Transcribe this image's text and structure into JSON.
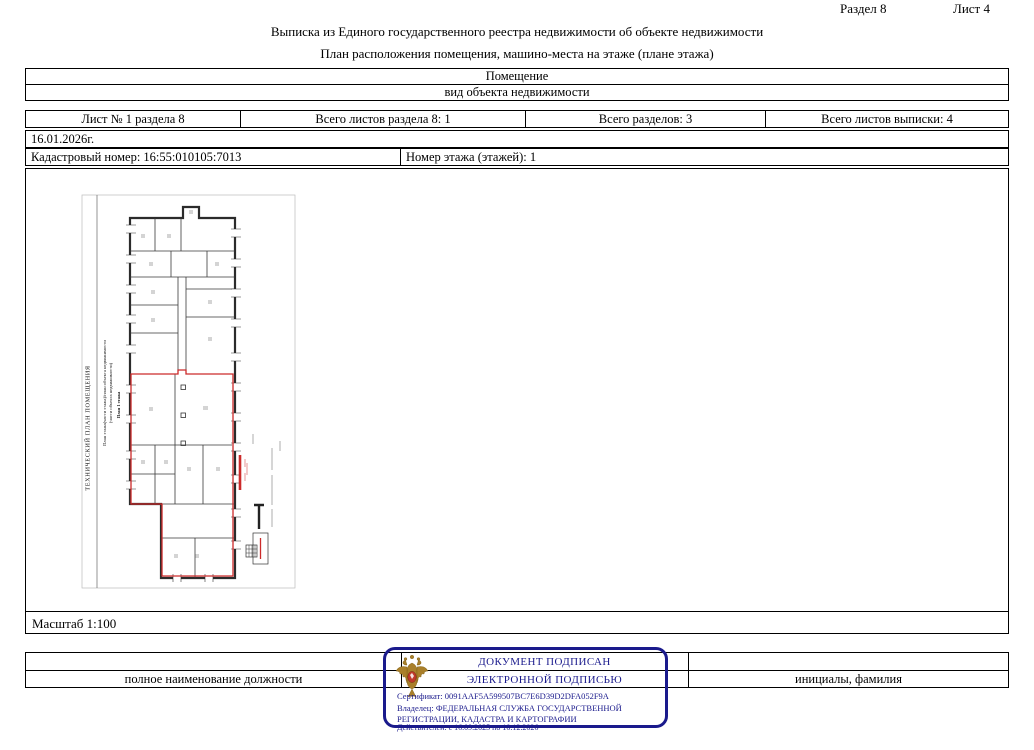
{
  "page": {
    "section_label": "Раздел 8",
    "sheet_label": "Лист 4",
    "title1": "Выписка из Единого государственного реестра недвижимости об объекте недвижимости",
    "title2": "План расположения помещения, машино-места на этаже (плане этажа)"
  },
  "object_table": {
    "type": "Помещение",
    "type_caption": "вид объекта недвижимости"
  },
  "sheet_info": {
    "cells": [
      "Лист № 1 раздела 8",
      "Всего листов раздела 8: 1",
      "Всего разделов: 3",
      "Всего листов выписки: 4"
    ]
  },
  "date_row": "16.01.2026г.",
  "cadastral_row": {
    "cadastral_number": "Кадастровый номер: 16:55:010105:7013",
    "floor_number": "Номер этажа (этажей): 1"
  },
  "plan": {
    "side_caption1": "ТЕХНИЧЕСКИЙ ПЛАН ПОМЕЩЕНИЯ",
    "side_caption2a": "План этажа(части этажа)/план объекта недвижимости",
    "side_caption2b": "(части объекта недвижимости)",
    "side_caption3": "План 1 этажа",
    "scale_label": "Масштаб 1:100",
    "boundary_color": "#cc2a2a"
  },
  "signature_block": {
    "position_label": "полное наименование должности",
    "name_label": "инициалы, фамилия"
  },
  "stamp": {
    "line1": "ДОКУМЕНТ ПОДПИСАН",
    "line2": "ЭЛЕКТРОННОЙ ПОДПИСЬЮ",
    "certificate": "Сертификат: 0091AAF5A599507BC7E6D39D2DFA052F9A",
    "owner1": "Владелец: ФЕДЕРАЛЬНАЯ СЛУЖБА ГОСУДАРСТВЕННОЙ",
    "owner2": "РЕГИСТРАЦИИ, КАДАСТРА И КАРТОГРАФИИ",
    "validity": "Действителен: с 16.09.2025 по 10.12.2026",
    "border_color": "#1a1a8c"
  }
}
